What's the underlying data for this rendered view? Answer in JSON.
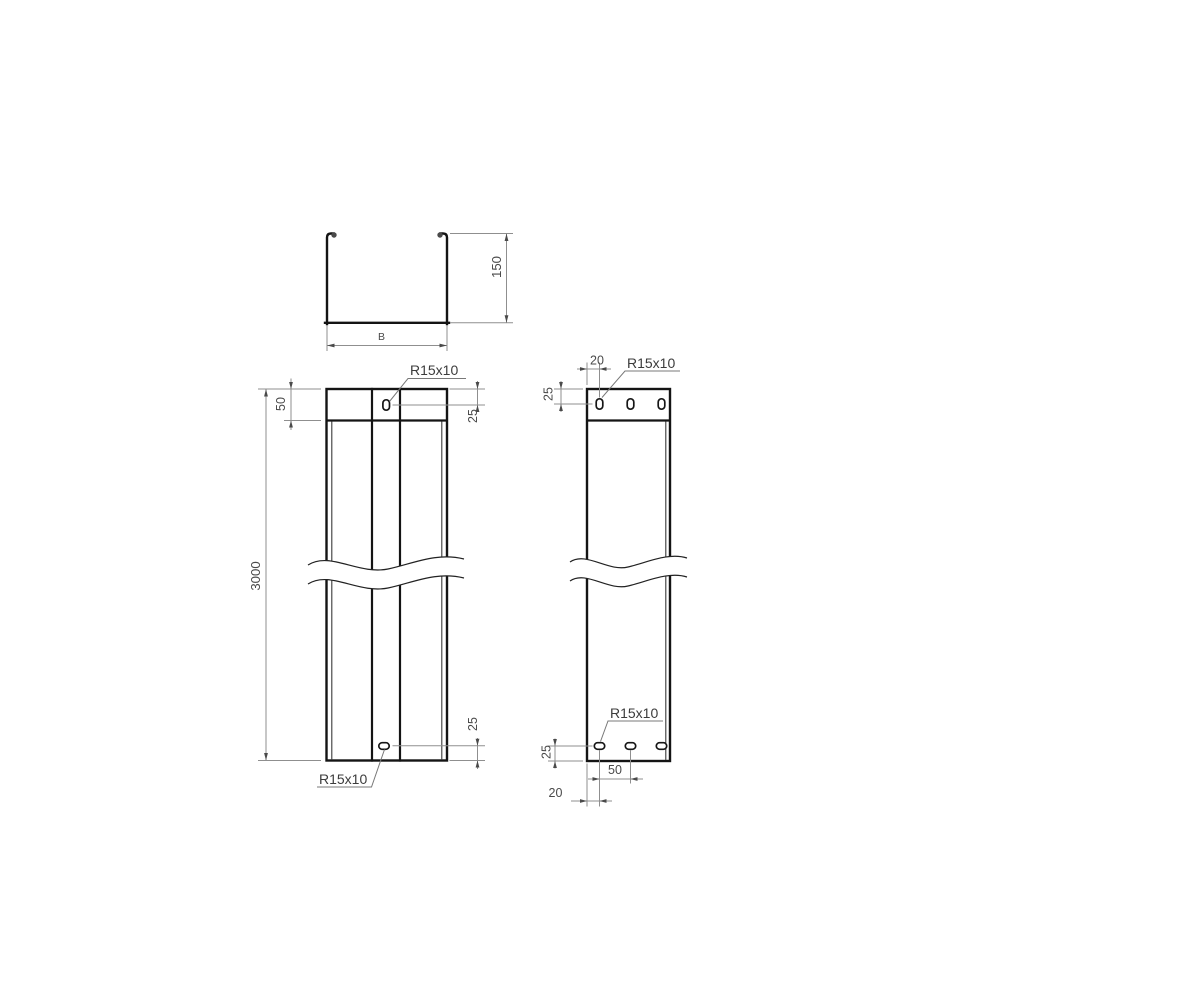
{
  "drawing_type": "cable-tray technical drawing",
  "colors": {
    "background": "#ffffff",
    "part_line": "#141414",
    "dimension_line": "#8f8f8f",
    "dimension_text": "#4a4a4a"
  },
  "views": {
    "cross_section": {
      "height": "150",
      "width": "B"
    },
    "front": {
      "end_zone": "50",
      "length": "3000",
      "slot_top_label": "R15x10",
      "slot_top_offset": "25",
      "slot_bottom_offset": "25",
      "slot_bottom_label": "R15x10"
    },
    "side": {
      "margin_top": "20",
      "slot_top_offset": "25",
      "slot_top_label": "R15x10",
      "slot_bottom_label": "R15x10",
      "slot_bottom_offset": "25",
      "slot_pitch": "50",
      "margin_bottom": "20"
    }
  }
}
